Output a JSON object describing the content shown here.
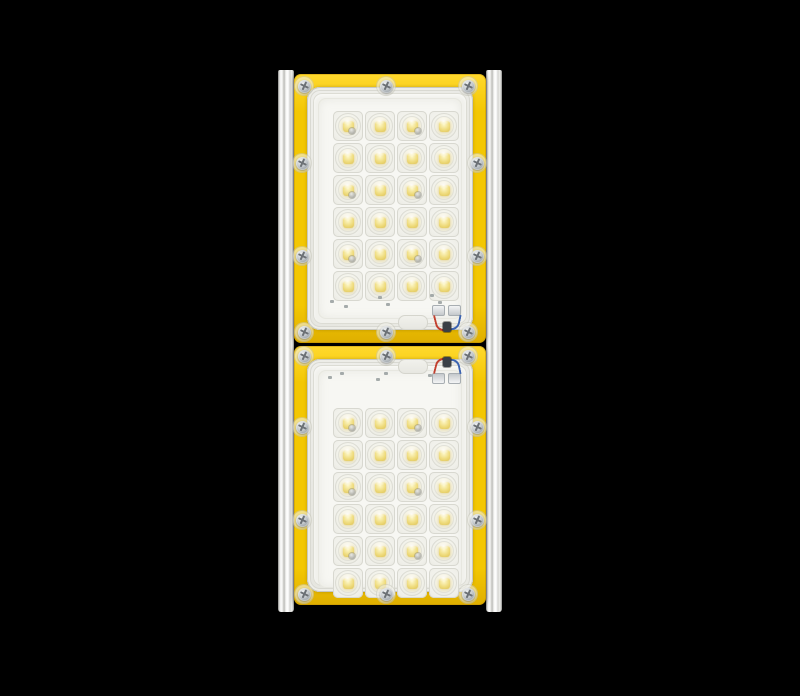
{
  "meta": {
    "description": "Product photograph of an industrial two-module LED luminaire (floodlight) viewed from the front on a plain black background"
  },
  "fixture": {
    "name": "two-module LED luminaire",
    "module_count": 2,
    "total_led_count": 48,
    "total_screw_count": 20,
    "colors": {
      "background": "#000000",
      "gasket_yellow": "#F3C703",
      "gasket_yellow_light": "#FFD92E",
      "gasket_yellow_dark": "#DFAF00",
      "rail_silver": "#E9E9E6",
      "cover_gray": "#EBEBE6",
      "pcb_white": "#F7F7F3",
      "led_phosphor_yellow": "#EFDC7E",
      "screw_silver": "#B9BEC3",
      "wire_red": "#C2402F",
      "wire_blue": "#3C63B0"
    },
    "modules": [
      {
        "position": "top",
        "led_rows": 6,
        "led_columns": 4,
        "led_count": 24,
        "screw_count": 10,
        "blank_pcb_strip": "bottom",
        "cable_entry": "bottom-right",
        "wire_colors": [
          "red",
          "blue"
        ]
      },
      {
        "position": "bottom",
        "led_rows": 6,
        "led_columns": 4,
        "led_count": 24,
        "screw_count": 10,
        "blank_pcb_strip": "top",
        "cable_entry": "top-right",
        "wire_colors": [
          "red",
          "blue"
        ]
      }
    ]
  }
}
